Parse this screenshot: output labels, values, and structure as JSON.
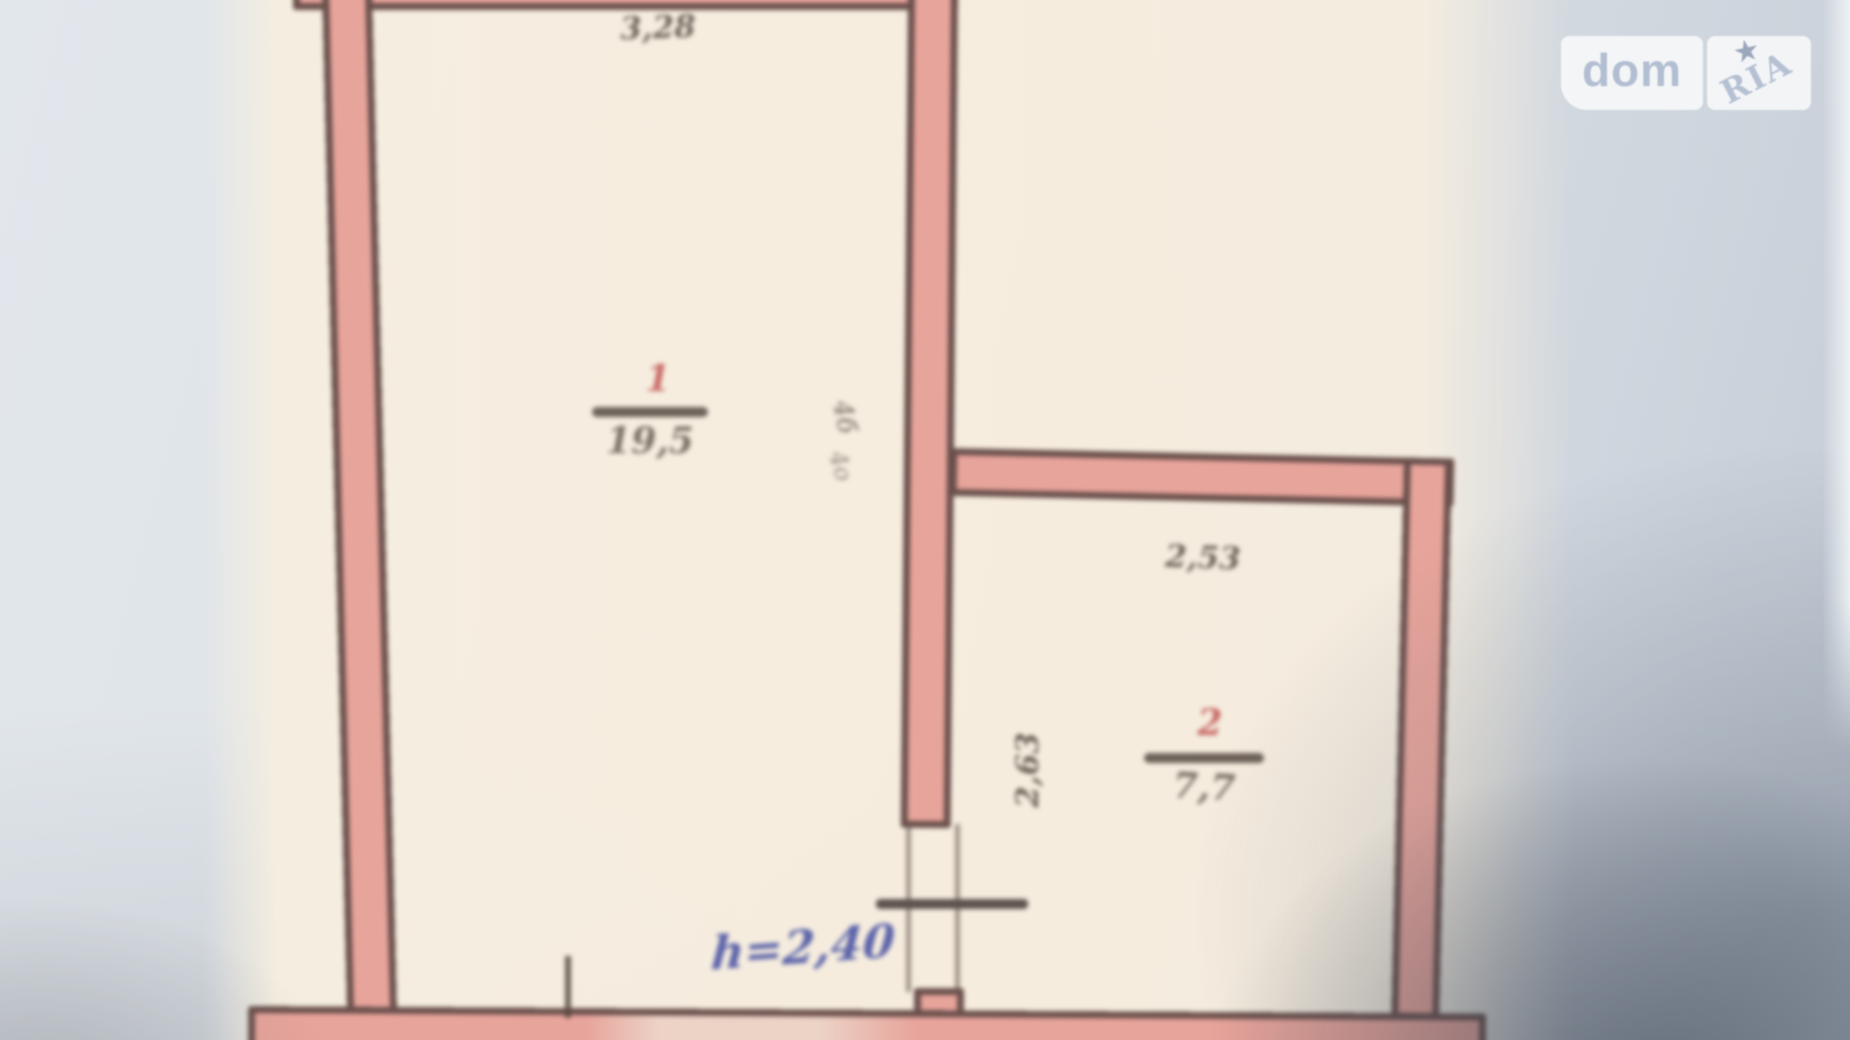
{
  "watermark": {
    "left_text": "dom",
    "right_text": "RIA",
    "star": "★"
  },
  "plan": {
    "rooms": [
      {
        "number": "1",
        "area": "19,5"
      },
      {
        "number": "2",
        "area": "7,7"
      }
    ],
    "dimensions": {
      "top_width": "3,28",
      "room2_width": "2,53",
      "room2_height": "2,63",
      "ceiling_height": "h=2,40"
    },
    "annotations": [
      {
        "text": "4б"
      },
      {
        "text": "4о"
      }
    ]
  },
  "colors": {
    "wall_fill": "#e7a49b",
    "wall_outline": "#6a4f4b",
    "paper": "#f5ecdc",
    "background": "#d9dee4",
    "room_number_red": "#c96a66",
    "ink_blue": "#5c63a9",
    "dimension_text": "#6f655c",
    "watermark_text": "#b2bed1"
  }
}
